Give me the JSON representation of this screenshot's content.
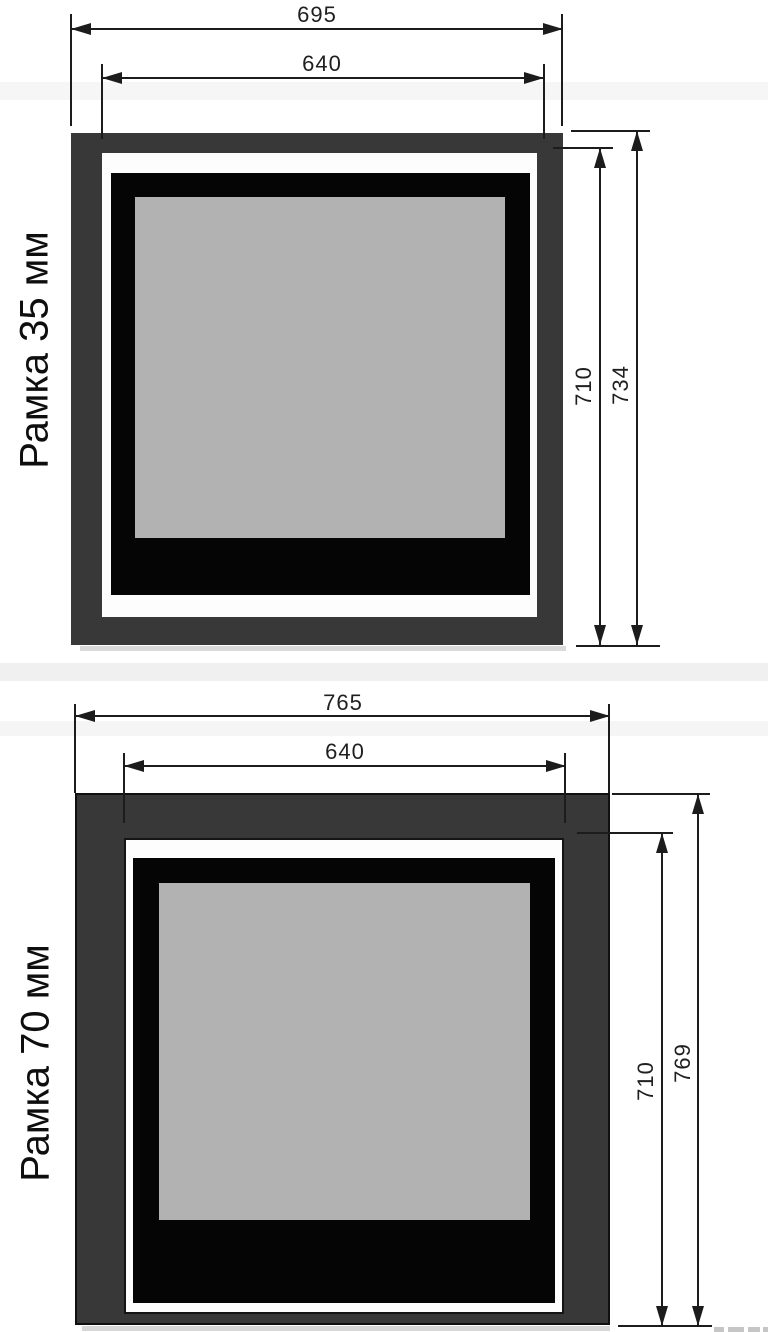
{
  "colors": {
    "frame_dark_gray": "#383838",
    "frame_outline_black": "#101010",
    "insert_black": "#050505",
    "glass_gray": "#b2b2b2",
    "gap_white": "#fdfdfd",
    "dimension_line": "#1c1c1c",
    "background": "#ffffff"
  },
  "diagrams": [
    {
      "side_label": "Рамка 35 мм",
      "dimensions": {
        "outer_width_mm": "695",
        "opening_width_mm": "640",
        "opening_height_mm": "710",
        "outer_height_mm": "734"
      }
    },
    {
      "side_label": "Рамка 70 мм",
      "dimensions": {
        "outer_width_mm": "765",
        "opening_width_mm": "640",
        "opening_height_mm": "710",
        "outer_height_mm": "769"
      }
    }
  ]
}
